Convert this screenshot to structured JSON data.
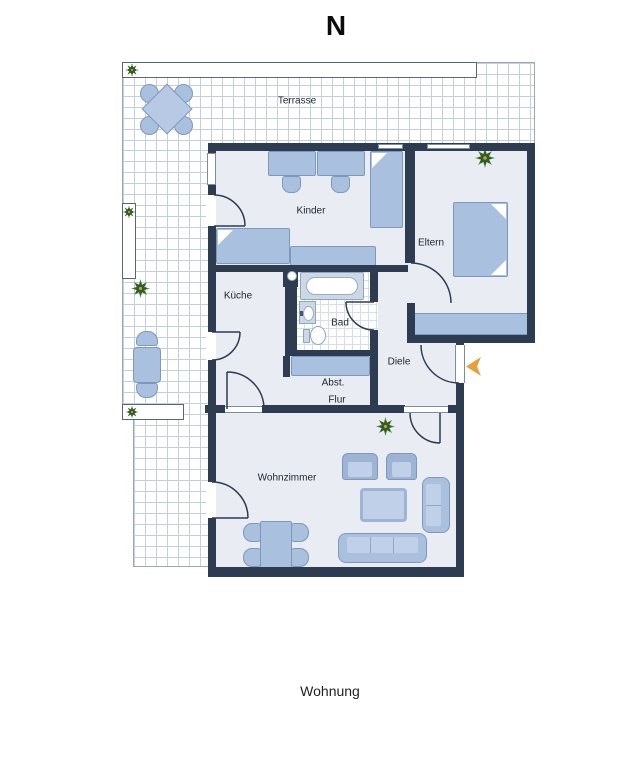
{
  "compass": {
    "label": "N"
  },
  "caption": "Wohnung",
  "rooms": {
    "terrasse": "Terrasse",
    "kinder": "Kinder",
    "eltern": "Eltern",
    "kueche": "Küche",
    "bad": "Bad",
    "abst": "Abst.",
    "flur": "Flur",
    "diele": "Diele",
    "wohnzimmer": "Wohnzimmer"
  },
  "planters": {
    "top": 20,
    "left": 5,
    "bottom": 4
  },
  "colors": {
    "wall": "#2e3c52",
    "floor": "#e9edf3",
    "furniture_fill": "#a9c0de",
    "furniture_border": "#7e98bd",
    "cushion": "#bfd0e8",
    "terrace_grid": "#c3cfdc",
    "bad_grid": "#d6dfe8",
    "counter": "#ccd8e5",
    "entrance_arrow": "#e6a13e",
    "label": "#1d2430"
  }
}
